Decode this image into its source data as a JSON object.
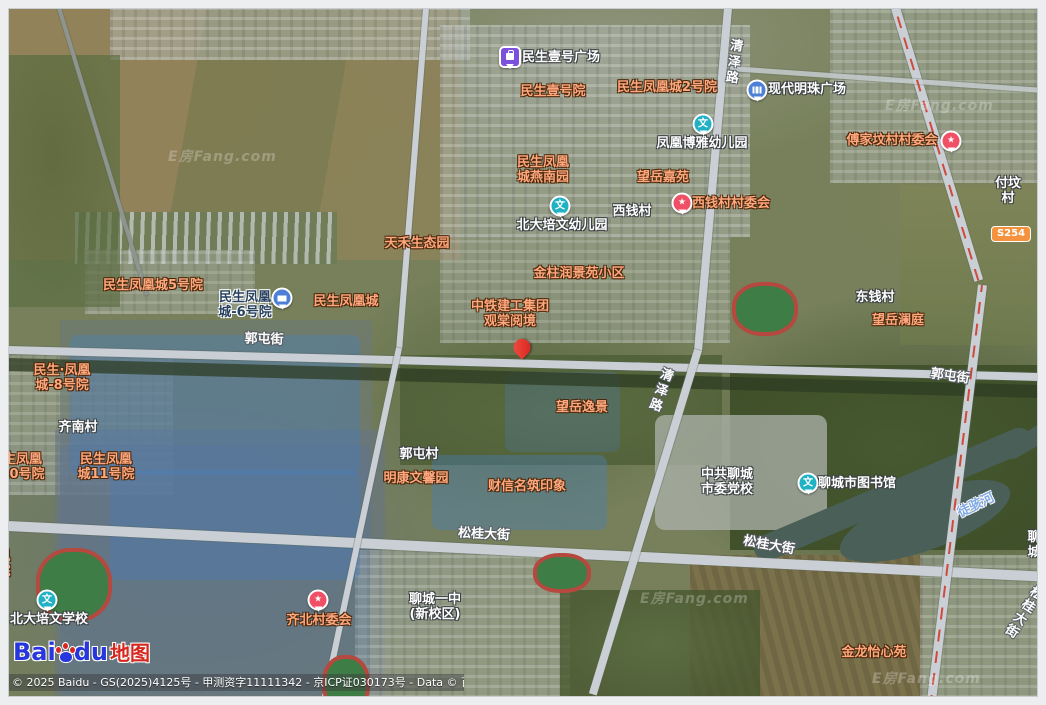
{
  "attribution": {
    "copyright": "© 2025 Baidu - GS(2025)4125号 - 甲测资字11111342 - 京ICP证030173号 - Data © 百度智图",
    "logo_bai": "Bai",
    "logo_du": "du",
    "logo_suffix": "地图"
  },
  "watermark": {
    "text": "E房Fang.com",
    "positions": [
      {
        "x": 168,
        "y": 146
      },
      {
        "x": 885,
        "y": 95
      },
      {
        "x": 640,
        "y": 588
      },
      {
        "x": 872,
        "y": 668
      }
    ]
  },
  "colors": {
    "label_orange": "#ffa77d",
    "label_white": "#ffffff",
    "water_label": "#7fa9e6",
    "marker_teal": "#20b2c4",
    "marker_red": "#ef5065",
    "marker_blue": "#4d7fd6",
    "marker_purple": "#7b50dd",
    "pin_red": "#d92019",
    "badge_orange": "#f5923e",
    "baidu_blue": "#2836dd",
    "baidu_red": "#d6281e"
  },
  "map": {
    "road_badge": {
      "text": "S254",
      "x": 1011,
      "y": 234
    },
    "labels": [
      {
        "text": "民生壹号广场",
        "x": 522,
        "y": 50,
        "style": "white",
        "align": "left",
        "clickable": true,
        "name": "label-minsheng-yihao-plaza"
      },
      {
        "text": "民生壹号院",
        "x": 553,
        "y": 84,
        "style": "orange",
        "clickable": true,
        "name": "label-minsheng-yihao-yard"
      },
      {
        "text": "民生凤凰城2号院",
        "x": 667,
        "y": 80,
        "style": "orange",
        "clickable": true,
        "name": "label-phoenix-city-2"
      },
      {
        "text": "现代明珠广场",
        "x": 768,
        "y": 82,
        "style": "white",
        "align": "left",
        "clickable": true,
        "name": "label-modern-pearl-plaza"
      },
      {
        "text": "凤凰博雅幼儿园",
        "x": 702,
        "y": 136,
        "style": "white",
        "clickable": true,
        "name": "label-boya-kindergarten"
      },
      {
        "text": "傅家坟村村委会",
        "x": 892,
        "y": 133,
        "style": "orange",
        "clickable": true,
        "name": "label-fujiafen-committee"
      },
      {
        "text": "民生凤凰\n城燕南园",
        "x": 543,
        "y": 155,
        "style": "orange",
        "clickable": true,
        "name": "label-yannan-garden"
      },
      {
        "text": "望岳嘉苑",
        "x": 663,
        "y": 170,
        "style": "orange",
        "clickable": true,
        "name": "label-wangyue-jiayuan"
      },
      {
        "text": "付坟村",
        "x": 1008,
        "y": 176,
        "style": "white",
        "clickable": true,
        "name": "label-fufen-village"
      },
      {
        "text": "西钱村",
        "x": 632,
        "y": 204,
        "style": "white",
        "clickable": true,
        "name": "label-xiqian-village"
      },
      {
        "text": "西钱村村委会",
        "x": 731,
        "y": 196,
        "style": "orange",
        "clickable": true,
        "name": "label-xiqian-committee"
      },
      {
        "text": "北大培文幼儿园",
        "x": 562,
        "y": 218,
        "style": "white",
        "clickable": true,
        "name": "label-peiwen-kindergarten"
      },
      {
        "text": "天禾生态园",
        "x": 417,
        "y": 236,
        "style": "orange",
        "clickable": true,
        "name": "label-tianhe-eco-park"
      },
      {
        "text": "金柱润景苑小区",
        "x": 579,
        "y": 266,
        "style": "orange",
        "clickable": true,
        "name": "label-jinzhu-runjingyuan"
      },
      {
        "text": "民生凤凰城5号院",
        "x": 153,
        "y": 278,
        "style": "orange",
        "clickable": true,
        "name": "label-phoenix-city-5"
      },
      {
        "text": "民生凤凰\n城-6号院",
        "x": 245,
        "y": 290,
        "style": "dark",
        "clickable": true,
        "name": "label-phoenix-city-6"
      },
      {
        "text": "民生凤凰城",
        "x": 346,
        "y": 294,
        "style": "orange",
        "clickable": true,
        "name": "label-phoenix-city"
      },
      {
        "text": "东钱村",
        "x": 875,
        "y": 290,
        "style": "white",
        "clickable": true,
        "name": "label-dongqian-village"
      },
      {
        "text": "中铁建工集团\n观棠阅境",
        "x": 510,
        "y": 299,
        "style": "orange",
        "clickable": true,
        "name": "label-guantang-yuejing"
      },
      {
        "text": "望岳澜庭",
        "x": 898,
        "y": 313,
        "style": "orange",
        "clickable": true,
        "name": "label-wangyue-lanting"
      },
      {
        "text": "民生·凤凰\n城-8号院",
        "x": 62,
        "y": 363,
        "style": "orange",
        "clickable": true,
        "name": "label-phoenix-city-8"
      },
      {
        "text": "望岳逸景",
        "x": 582,
        "y": 400,
        "style": "orange",
        "clickable": true,
        "name": "label-wangyue-yijing"
      },
      {
        "text": "齐南村",
        "x": 78,
        "y": 420,
        "style": "white",
        "clickable": true,
        "name": "label-qinan-village"
      },
      {
        "text": "郭屯村",
        "x": 419,
        "y": 447,
        "style": "white",
        "clickable": true,
        "name": "label-guotun-village"
      },
      {
        "text": "民生凤凰\n城10号院",
        "x": 16,
        "y": 452,
        "style": "orange",
        "clickable": true,
        "name": "label-phoenix-city-10"
      },
      {
        "text": "民生凤凰\n城11号院",
        "x": 106,
        "y": 452,
        "style": "orange",
        "clickable": true,
        "name": "label-phoenix-city-11"
      },
      {
        "text": "明康文馨园",
        "x": 416,
        "y": 471,
        "style": "orange",
        "clickable": true,
        "name": "label-mingkang-wenxinyuan"
      },
      {
        "text": "中共聊城\n市委党校",
        "x": 727,
        "y": 467,
        "style": "white",
        "clickable": true,
        "name": "label-party-school"
      },
      {
        "text": "财信名筑印象",
        "x": 527,
        "y": 479,
        "style": "orange",
        "clickable": true,
        "name": "label-caixin-mingzhu"
      },
      {
        "text": "聊城市图书馆",
        "x": 818,
        "y": 476,
        "style": "white",
        "align": "left",
        "clickable": true,
        "name": "label-liaocheng-library"
      },
      {
        "text": "聊城",
        "x": 1022,
        "y": 530,
        "style": "white",
        "align": "left",
        "clickable": true,
        "name": "label-liaocheng-clipped"
      },
      {
        "text": "凰\n院",
        "x": 4,
        "y": 549,
        "style": "orange",
        "clickable": true,
        "name": "label-clipped-left"
      },
      {
        "text": "聊城一中\n(新校区)",
        "x": 435,
        "y": 592,
        "style": "white",
        "clickable": true,
        "name": "label-no1-middle-school"
      },
      {
        "text": "北大培文学校",
        "x": 49,
        "y": 612,
        "style": "white",
        "clickable": true,
        "name": "label-peiwen-school"
      },
      {
        "text": "齐北村委会",
        "x": 319,
        "y": 613,
        "style": "orange",
        "clickable": true,
        "name": "label-qibei-committee"
      },
      {
        "text": "金龙怡心苑",
        "x": 874,
        "y": 645,
        "style": "orange",
        "clickable": true,
        "name": "label-jinlong-yixinyuan"
      },
      {
        "text": "郭屯街",
        "x": 264,
        "y": 332,
        "style": "road",
        "rotate": 2,
        "clickable": false,
        "name": "label-guotun-street"
      },
      {
        "text": "郭屯街",
        "x": 950,
        "y": 369,
        "style": "road",
        "rotate": 8,
        "clickable": false,
        "name": "label-guotun-street-east"
      },
      {
        "text": "松桂大街",
        "x": 484,
        "y": 527,
        "style": "road",
        "rotate": 3,
        "clickable": false,
        "name": "label-songgui-avenue"
      },
      {
        "text": "松桂大街",
        "x": 769,
        "y": 538,
        "style": "road",
        "rotate": 10,
        "clickable": false,
        "name": "label-songgui-avenue-east"
      },
      {
        "text": "松桂大街",
        "x": 1024,
        "y": 583,
        "style": "road",
        "rotate": 33,
        "clickable": false,
        "name": "label-songgui-avenue-clipped"
      },
      {
        "text": "清泽路",
        "x": 732,
        "y": 38,
        "style": "road",
        "rotate": 8,
        "vertical": true,
        "clickable": false,
        "name": "label-qingze-road-north"
      },
      {
        "text": "清泽路",
        "x": 659,
        "y": 366,
        "style": "road",
        "rotate": 20,
        "vertical": true,
        "clickable": false,
        "name": "label-qingze-road-south"
      },
      {
        "text": "徒骇河",
        "x": 976,
        "y": 498,
        "style": "water",
        "rotate": -26,
        "clickable": false,
        "name": "label-tuhai-river"
      }
    ],
    "markers": [
      {
        "type": "pin-red",
        "x": 522,
        "y": 356,
        "name": "selected-location-pin"
      },
      {
        "type": "square-purple",
        "glyph": "bag",
        "x": 510,
        "y": 57,
        "name": "shopping-plaza-marker"
      },
      {
        "type": "balloon-blue",
        "glyph": "building",
        "x": 757,
        "y": 90,
        "name": "modern-pearl-plaza-marker"
      },
      {
        "type": "balloon-blue",
        "glyph": "bank",
        "x": 282,
        "y": 298,
        "name": "bank-marker"
      },
      {
        "type": "circle-teal",
        "glyph": "文",
        "x": 703,
        "y": 124,
        "name": "boya-kindergarten-marker"
      },
      {
        "type": "circle-teal",
        "glyph": "文",
        "x": 560,
        "y": 206,
        "name": "peiwen-kindergarten-marker"
      },
      {
        "type": "circle-teal",
        "glyph": "文",
        "x": 47,
        "y": 600,
        "name": "peiwen-school-marker"
      },
      {
        "type": "circle-teal",
        "glyph": "文",
        "x": 808,
        "y": 483,
        "name": "library-marker"
      },
      {
        "type": "balloon-red",
        "glyph": "★",
        "x": 682,
        "y": 203,
        "name": "xiqian-committee-marker"
      },
      {
        "type": "balloon-red",
        "glyph": "★",
        "x": 951,
        "y": 141,
        "name": "fujiafen-committee-marker"
      },
      {
        "type": "balloon-red",
        "glyph": "★",
        "x": 318,
        "y": 600,
        "name": "qibei-committee-marker"
      }
    ]
  }
}
